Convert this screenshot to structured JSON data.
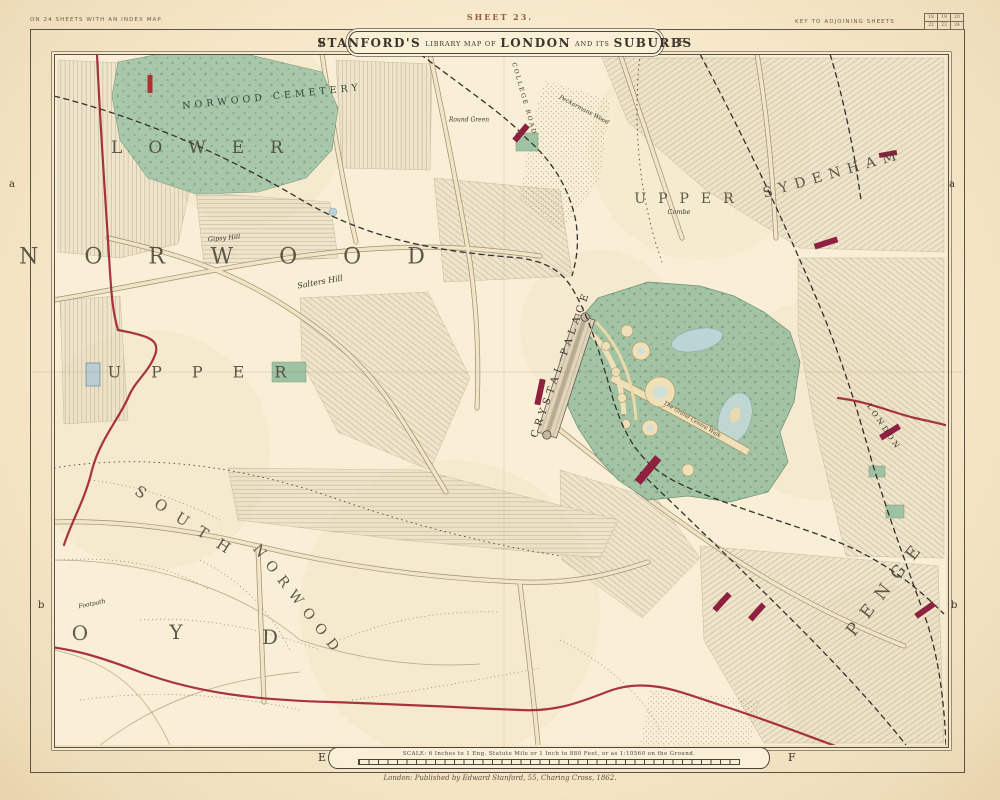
{
  "colors": {
    "paper": "#f6e8ca",
    "park_green": "#a3c3a5",
    "boundary_red": "#a01f30",
    "station_crimson": "#8e2040",
    "water_blue": "#bcd4d6",
    "ink": "#3a352c"
  },
  "header": {
    "sheet": "SHEET 23.",
    "left_note": "ON 24 SHEETS WITH AN INDEX MAP.",
    "right_note": "KEY TO ADJOINING SHEETS",
    "title_name": "STANFORD'S",
    "title_lib": "LIBRARY MAP OF",
    "title_city": "LONDON",
    "title_and": "AND ITS",
    "title_sub": "SUBURBS"
  },
  "key_grid": {
    "r1": [
      "18",
      "19",
      "20"
    ],
    "r2": [
      "22",
      "23",
      "24"
    ]
  },
  "grid_refs": {
    "col_e": "E",
    "col_f": "F",
    "row_a": "a",
    "row_b": "b"
  },
  "places": {
    "norwood_cemetery": "NORWOOD CEMETERY",
    "lower": "LOWER",
    "norwood": "NORWOOD",
    "upper": "UPPER",
    "south": "SOUTH",
    "norwood_south": "NORWOOD",
    "croydon_o": "O",
    "croydon_y": "Y",
    "croydon_d": "D",
    "penge": "PENGE",
    "upper_sydenham": "UPPER",
    "sydenham": "SYDENHAM",
    "combe": "Combe",
    "crystal_palace": "CRYSTAL PALACE",
    "salters_hill": "Salters Hill",
    "gipsy_hill": "Gipsy Hill",
    "footpath": "Footpath",
    "round_green": "Round Green",
    "college_road": "COLLEGE ROAD",
    "peckarmans_wood": "Peckarmans Wood",
    "grand_walk": "The Grand Centre Walk",
    "london_rail": "LONDON"
  },
  "footer": {
    "scale_text": "SCALE: 6 Inches to 1 Eng. Statute Mile or 1 Inch to 880 Feet, or as 1:10560 on the Ground.",
    "imprint": "London: Published by Edward Stanford, 55, Charing Cross, 1862."
  }
}
